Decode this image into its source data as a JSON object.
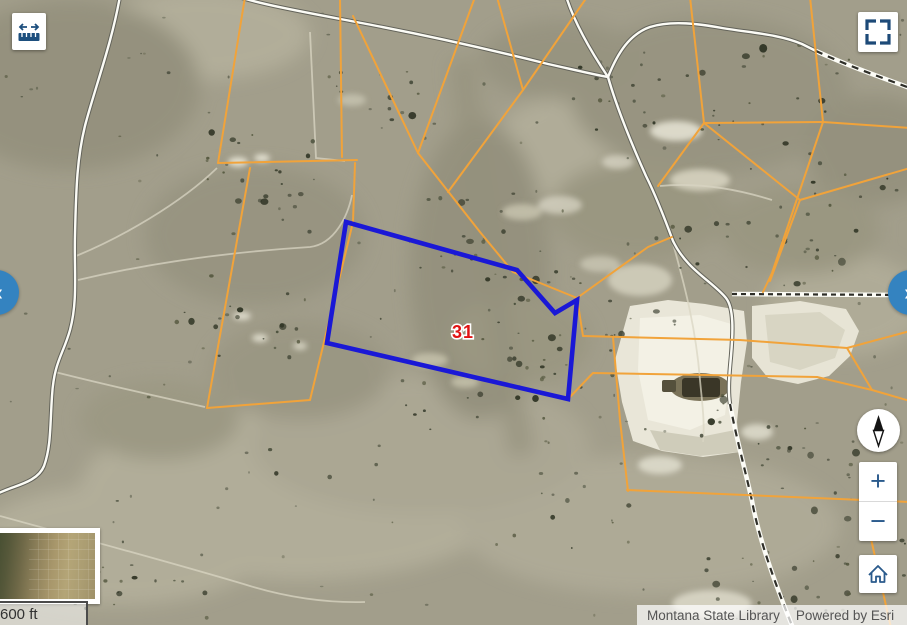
{
  "map": {
    "parcel_label": "31",
    "parcel_label_color": "#e01313",
    "selected_parcel_outline_color": "#1a18d6",
    "parcel_line_color": "#f1a33a"
  },
  "toolbar_top_left": {
    "measure_button": {
      "icon": "measure-distance-icon"
    }
  },
  "toolbar_top_right": {
    "button_color": "#15538a",
    "buttons": [
      {
        "name": "search-by-shape",
        "icon": "spatial-search-icon"
      },
      {
        "name": "basemap-gallery",
        "icon": "grid-icon"
      },
      {
        "name": "swipe-compare",
        "icon": "split-view-icon"
      },
      {
        "name": "print",
        "icon": "printer-icon"
      }
    ],
    "fullscreen_button": {
      "icon": "fullscreen-icon"
    }
  },
  "panel_toggles": {
    "color": "#3483c0",
    "left_glyph": "«",
    "right_glyph": "»"
  },
  "map_controls": {
    "compass": {
      "icon": "compass-needle-icon"
    },
    "zoom_in_glyph": "+",
    "zoom_out_glyph": "−",
    "home": {
      "icon": "home-icon"
    }
  },
  "overview_map": {
    "description": "overview-map-thumbnail"
  },
  "scale_bar": {
    "label": "600 ft"
  },
  "attribution": {
    "sources": "Montana State Library",
    "powered_by": "Powered by Esri"
  }
}
